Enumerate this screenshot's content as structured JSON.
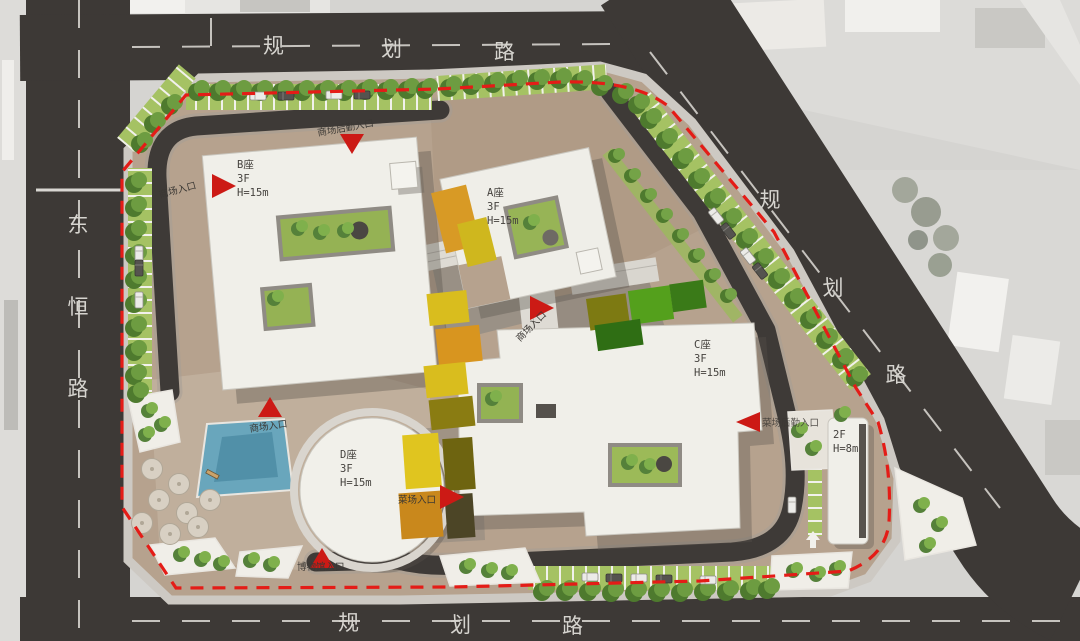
{
  "plan": {
    "type": "architectural-site-plan",
    "site_boundary": "red-dashed-line"
  },
  "roads": {
    "top": {
      "name": "规划路",
      "chars": [
        "规",
        "划",
        "路"
      ]
    },
    "left": {
      "name": "东恒路",
      "chars": [
        "东",
        "恒",
        "路"
      ]
    },
    "right": {
      "name": "规划路",
      "chars": [
        "规",
        "划",
        "路"
      ]
    },
    "bottom": {
      "name": "规划路",
      "chars": [
        "规",
        "划",
        "路"
      ]
    }
  },
  "buildings": {
    "a": {
      "name": "A座",
      "floors": "3F",
      "height": "H=15m"
    },
    "b": {
      "name": "B座",
      "floors": "3F",
      "height": "H=15m"
    },
    "c": {
      "name": "C座",
      "floors": "3F",
      "height": "H=15m"
    },
    "d": {
      "name": "D座",
      "floors": "3F",
      "height": "H=15m"
    },
    "annex": {
      "floors": "2F",
      "height": "H=8m"
    }
  },
  "entrances": {
    "west_mall": "商场入口",
    "north_service": "商场后勤入口",
    "center_mall": "商场入口",
    "plaza_mall": "商场入口",
    "market": "菜场入口",
    "east_market_service": "菜场后勤入口",
    "south_museum": "博物馆入口"
  },
  "colors": {
    "boundary_red": "#e41c17",
    "entrance_red": "#cc1a15",
    "road_dark": "#3d3936",
    "site_tan": "#b6a28e",
    "building_white": "#f0efe9",
    "landscape_green": "#a5c263",
    "tree_green": "#6d9c41",
    "water_blue": "#69a6bc",
    "canopy_yellow": "#d9bd1e",
    "canopy_orange": "#d8951f"
  }
}
